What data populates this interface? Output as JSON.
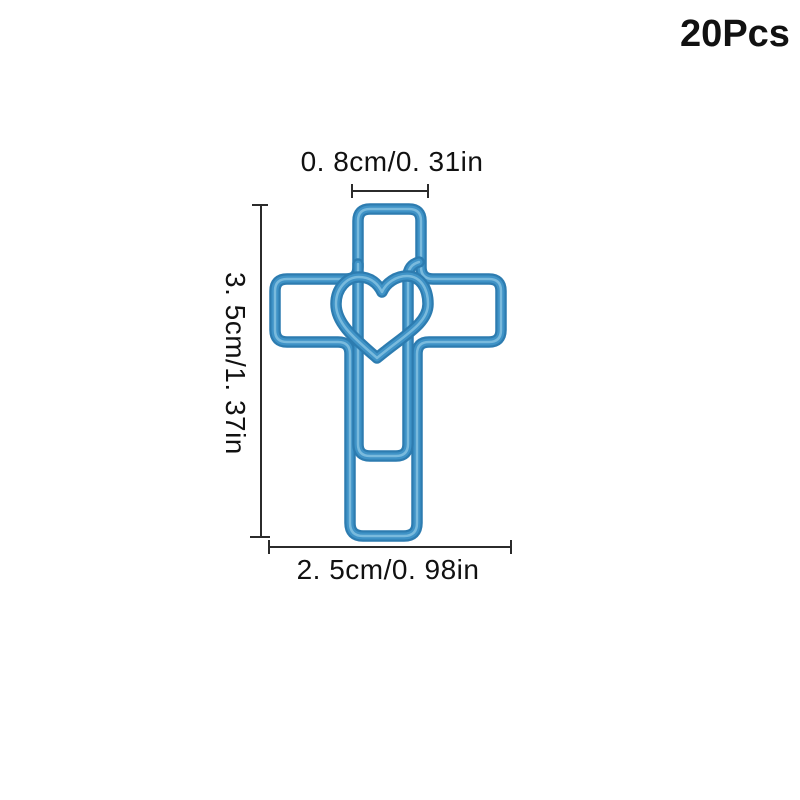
{
  "theme": {
    "background": "#ffffff",
    "text-color": "#111111",
    "measure-color": "#2b2b2b",
    "wire-base": "#2d7cb0",
    "wire-mid": "#3f93c7",
    "wire-sheen": "#84c1e1"
  },
  "badge": {
    "quantity_label": "20Pcs"
  },
  "illustration": {
    "item": "cross-with-heart-paper-clip",
    "wire_color_name": "blue"
  },
  "dimensions": {
    "top_width": "0. 8cm/0. 31in",
    "left_height": "3. 5cm/1. 37in",
    "bottom_width": "2. 5cm/0. 98in"
  }
}
